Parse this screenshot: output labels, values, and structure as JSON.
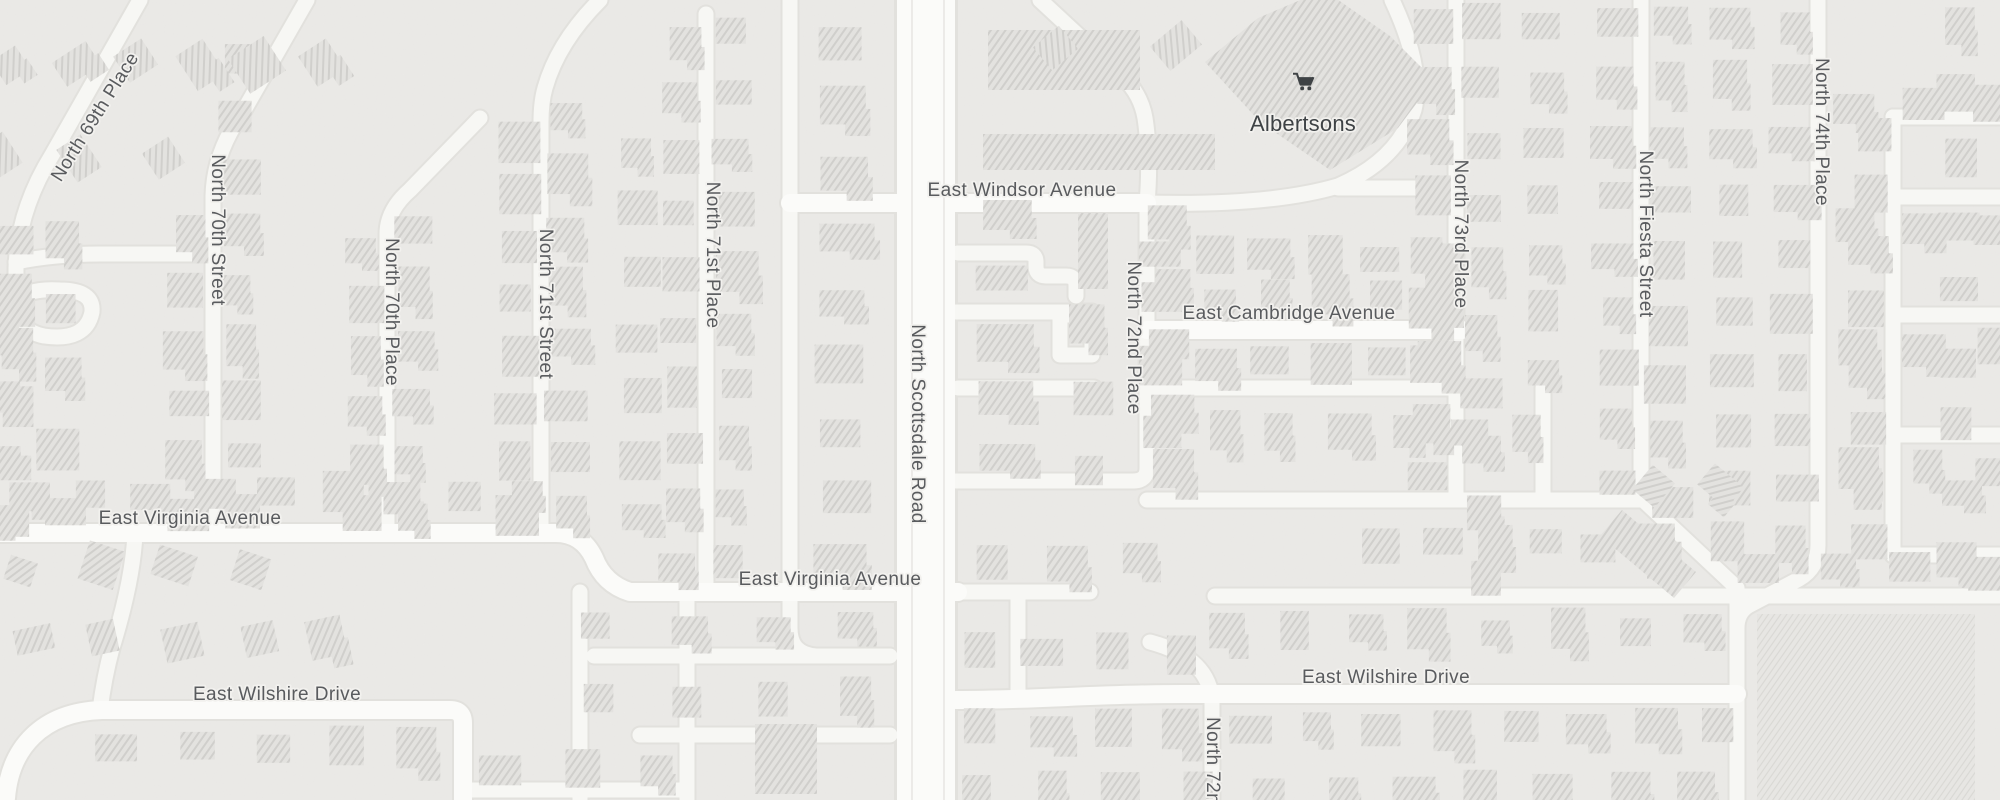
{
  "map": {
    "poi": {
      "name": "Albertsons",
      "icon": "shopping-cart-icon",
      "label_x": 1303,
      "label_y": 131,
      "icon_x": 1293,
      "icon_y": 72
    },
    "colors": {
      "background": "#ebeae7",
      "road_fill": "#fbfbf9",
      "road_minor_fill": "#f7f7f4",
      "road_casing": "#e2e1dd",
      "lane_line": "#e8e7e3",
      "building_fill": "#e3e2df",
      "building_hatch": "#d0cfcc",
      "block_fill": "#e7e6e3",
      "block_hatch": "#d9d8d4",
      "label_color": "#595b5e",
      "poi_color": "#3e4245"
    },
    "street_labels": [
      {
        "text": "North 69th Place",
        "x": 100,
        "y": 120,
        "rot": -58
      },
      {
        "text": "North 70th Street",
        "x": 212,
        "y": 230,
        "rot": 90
      },
      {
        "text": "North 70th Place",
        "x": 386,
        "y": 312,
        "rot": 90
      },
      {
        "text": "North 71st Street",
        "x": 540,
        "y": 304,
        "rot": 90
      },
      {
        "text": "North 71st Place",
        "x": 707,
        "y": 255,
        "rot": 90
      },
      {
        "text": "North Scottsdale Road",
        "x": 912,
        "y": 424,
        "rot": 90
      },
      {
        "text": "North 72nd Place",
        "x": 1128,
        "y": 338,
        "rot": 90
      },
      {
        "text": "North 72nd",
        "x": 1207,
        "y": 766,
        "rot": 90
      },
      {
        "text": "North 73rd Place",
        "x": 1455,
        "y": 234,
        "rot": 90
      },
      {
        "text": "North Fiesta Street",
        "x": 1640,
        "y": 234,
        "rot": 90
      },
      {
        "text": "North 74th Place",
        "x": 1816,
        "y": 132,
        "rot": 90
      },
      {
        "text": "East Windsor Avenue",
        "x": 1022,
        "y": 196,
        "rot": 0
      },
      {
        "text": "East Cambridge Avenue",
        "x": 1289,
        "y": 319,
        "rot": 0
      },
      {
        "text": "East Virginia Avenue",
        "x": 190,
        "y": 524,
        "rot": 0
      },
      {
        "text": "East Virginia Avenue",
        "x": 830,
        "y": 585,
        "rot": 0
      },
      {
        "text": "East Wilshire Drive",
        "x": 277,
        "y": 700,
        "rot": 0
      },
      {
        "text": "East Wilshire Drive",
        "x": 1386,
        "y": 683,
        "rot": 0
      }
    ],
    "roads": {
      "major": [
        "M926,0 V800"
      ],
      "lanes": [
        "M912,0 V800",
        "M944,0 V800"
      ],
      "avenues": [
        "M790,203 H1147",
        "M1147,330 H1462",
        "M0,533 H556 Q582,533 594,558 Q604,584 630,592 H958",
        "M6,798 C10,748 42,712 102,710 H450 Q463,710 463,723 V800",
        "M956,700 C1040,700 1092,694 1182,694 H1737"
      ],
      "minors": [
        "M140,0 L52,155 Q18,210 16,268 V330",
        "M16,262 Q55,254 100,254 H210",
        "M307,0 L243,112 Q214,152 213,196 V533",
        "M480,118 L410,190 Q387,210 387,234 V533",
        "M600,0 Q558,42 545,88 Q541,102 541,122 V533",
        "M706,14 V592",
        "M790,0 V628 Q790,654 816,656",
        "M1040,0 L1124,78 Q1141,95 1145,118 Q1151,158 1147,203",
        "M1392,0 Q1424,68 1414,110 Q1398,160 1338,186 Q1270,206 1147,203",
        "M1338,188 H1456",
        "M1147,203 V468 Q1147,481 1133,481",
        "M956,481 H1133",
        "M958,253 H1026 Q1036,253 1036,262 V266 Q1036,276 1046,276 H1066 Q1076,276 1076,286 V296",
        "M956,312 H1092",
        "M1060,315 H1092 V355 H1060 Z",
        "M958,388 H1094",
        "M1456,0 V500",
        "M1147,388 H1456",
        "M1147,500 H1641",
        "M1543,388 V500",
        "M1641,0 V498 L1737,588 V800",
        "M1215,596 H2000",
        "M1150,642 Q1210,658 1212,702 V800",
        "M1818,0 V545 Q1818,568 1799,579 L1748,606 Q1737,613 1737,628",
        "M1893,117 V555",
        "M1893,117 H2000",
        "M1893,197 H2000",
        "M1893,315 H2000",
        "M1893,435 H2000",
        "M1893,555 H2000",
        "M580,592 V800",
        "M687,592 V800",
        "M594,656 H890",
        "M640,735 H890",
        "M463,790 H687",
        "M135,533 Q133,580 112,648 Q104,678 100,710",
        "M20,300 Q14,330 44,336 Q86,342 92,312 Q94,290 60,290 Q28,288 20,300",
        "M958,592 H1090",
        "M1018,592 V694"
      ]
    },
    "buildings": {
      "polygons": [
        {
          "points": "1205,62 1258,18 1324,-10 1390,36 1434,80 1398,128 1330,170 1260,122",
          "name": "albertsons-building"
        },
        {
          "points": "1600,536 1622,510 1696,572 1674,598",
          "name": "building"
        }
      ],
      "rects": [
        [
          983,
          134,
          232,
          36
        ],
        [
          988,
          30,
          152,
          60
        ],
        [
          1078,
          213,
          30,
          76
        ],
        [
          755,
          724,
          62,
          70
        ]
      ],
      "big_block": [
        1757,
        614,
        218,
        186
      ],
      "columns": [
        {
          "x": 188,
          "y0": 235,
          "y1": 515,
          "n": 6
        },
        {
          "x": 240,
          "y0": 60,
          "y1": 515,
          "n": 9
        },
        {
          "x": 363,
          "y0": 250,
          "y1": 515,
          "n": 6
        },
        {
          "x": 413,
          "y0": 230,
          "y1": 515,
          "n": 6
        },
        {
          "x": 516,
          "y0": 140,
          "y1": 515,
          "n": 8
        },
        {
          "x": 568,
          "y0": 120,
          "y1": 515,
          "n": 8
        },
        {
          "x": 640,
          "y0": 150,
          "y1": 520,
          "n": 7
        },
        {
          "x": 681,
          "y0": 40,
          "y1": 565,
          "n": 10
        },
        {
          "x": 733,
          "y0": 30,
          "y1": 565,
          "n": 10
        },
        {
          "x": 843,
          "y0": 40,
          "y1": 560,
          "n": 9,
          "w": 40
        },
        {
          "x": 1005,
          "y0": 218,
          "y1": 460,
          "n": 5,
          "w": 46
        },
        {
          "x": 1090,
          "y0": 320,
          "y1": 470,
          "n": 3
        },
        {
          "x": 1172,
          "y0": 220,
          "y1": 470,
          "n": 5
        },
        {
          "x": 1431,
          "y0": 25,
          "y1": 480,
          "n": 9
        },
        {
          "x": 1483,
          "y0": 25,
          "y1": 575,
          "n": 10
        },
        {
          "x": 1545,
          "y0": 30,
          "y1": 370,
          "n": 7
        },
        {
          "x": 1616,
          "y0": 25,
          "y1": 480,
          "n": 9
        },
        {
          "x": 1668,
          "y0": 25,
          "y1": 560,
          "n": 10
        },
        {
          "x": 1730,
          "y0": 25,
          "y1": 545,
          "n": 10
        },
        {
          "x": 1793,
          "y0": 25,
          "y1": 545,
          "n": 10
        },
        {
          "x": 15,
          "y0": 240,
          "y1": 520,
          "n": 6
        },
        {
          "x": 62,
          "y0": 240,
          "y1": 515,
          "n": 5
        },
        {
          "x": 2,
          "y0": 330,
          "y1": 520,
          "n": 4
        },
        {
          "x": 1870,
          "y0": 135,
          "y1": 545,
          "n": 8
        },
        {
          "x": 1960,
          "y0": 25,
          "y1": 560,
          "n": 9
        }
      ],
      "rows": [
        {
          "y": 62,
          "x0": 10,
          "x1": 320,
          "n": 6,
          "rot": -33
        },
        {
          "y": 160,
          "x0": 0,
          "x1": 160,
          "n": 3,
          "rot": -33
        },
        {
          "y": 495,
          "x0": 30,
          "x1": 530,
          "n": 9
        },
        {
          "y": 568,
          "x0": 25,
          "x1": 250,
          "n": 4,
          "rot": 18
        },
        {
          "y": 640,
          "x0": 30,
          "x1": 330,
          "n": 5,
          "rot": -12
        },
        {
          "y": 745,
          "x0": 120,
          "x1": 420,
          "n": 5
        },
        {
          "y": 628,
          "x0": 600,
          "x1": 860,
          "n": 4
        },
        {
          "y": 700,
          "x0": 600,
          "x1": 860,
          "n": 4
        },
        {
          "y": 770,
          "x0": 500,
          "x1": 660,
          "n": 3
        },
        {
          "y": 258,
          "x0": 1160,
          "x1": 1440,
          "n": 6
        },
        {
          "y": 298,
          "x0": 1160,
          "x1": 1440,
          "n": 6
        },
        {
          "y": 362,
          "x0": 1160,
          "x1": 1440,
          "n": 6
        },
        {
          "y": 432,
          "x0": 1160,
          "x1": 1530,
          "n": 7
        },
        {
          "y": 545,
          "x0": 1385,
          "x1": 1650,
          "n": 6
        },
        {
          "y": 570,
          "x0": 1760,
          "x1": 1990,
          "n": 4
        },
        {
          "y": 630,
          "x0": 1230,
          "x1": 1700,
          "n": 8
        },
        {
          "y": 652,
          "x0": 980,
          "x1": 1180,
          "n": 4
        },
        {
          "y": 728,
          "x0": 980,
          "x1": 1720,
          "n": 12
        },
        {
          "y": 790,
          "x0": 980,
          "x1": 1700,
          "n": 11
        },
        {
          "y": 105,
          "x0": 1855,
          "x1": 1995,
          "n": 3
        },
        {
          "y": 228,
          "x0": 1855,
          "x1": 1995,
          "n": 3
        },
        {
          "y": 350,
          "x0": 1855,
          "x1": 1995,
          "n": 3
        },
        {
          "y": 470,
          "x0": 1855,
          "x1": 1995,
          "n": 3
        },
        {
          "y": 560,
          "x0": 990,
          "x1": 1140,
          "n": 3
        },
        {
          "y": 45,
          "x0": 1060,
          "x1": 1180,
          "n": 2,
          "rot": -40
        },
        {
          "y": 485,
          "x0": 1655,
          "x1": 1725,
          "n": 2,
          "rot": 40
        }
      ]
    }
  }
}
